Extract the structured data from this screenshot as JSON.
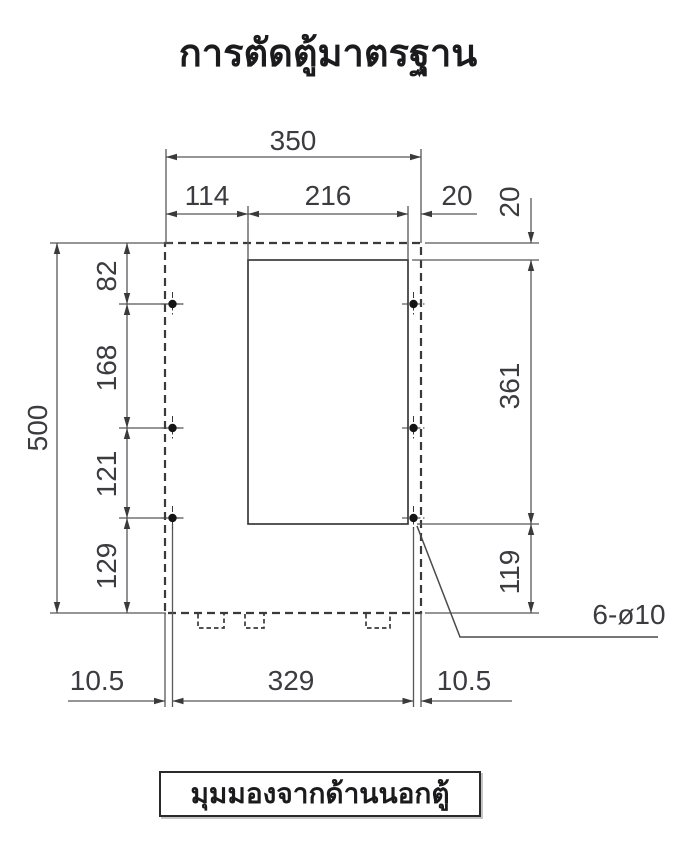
{
  "title": "การตัดตู้มาตรฐาน",
  "caption": "มุมมองจากด้านนอกตู้",
  "hole_callout": "6-ø10",
  "dims": {
    "overall_width": "350",
    "cutout_left_offset": "114",
    "cutout_width": "216",
    "cutout_right_gap": "20",
    "cutout_top_gap": "20",
    "overall_height": "500",
    "top_to_hole_row1": "82",
    "hole_row1_to_row2": "168",
    "hole_row2_to_row3": "121",
    "hole_row3_to_bottom": "129",
    "cutout_height": "361",
    "cutout_bottom_to_edge": "119",
    "bottom_left_margin": "10.5",
    "hole_span_width": "329",
    "bottom_right_margin": "10.5"
  },
  "colors": {
    "cutout_fill": "#e2e6e9",
    "outline": "#3a3a3a",
    "dim_line": "#58585a",
    "dim_text": "#3b3b40"
  }
}
